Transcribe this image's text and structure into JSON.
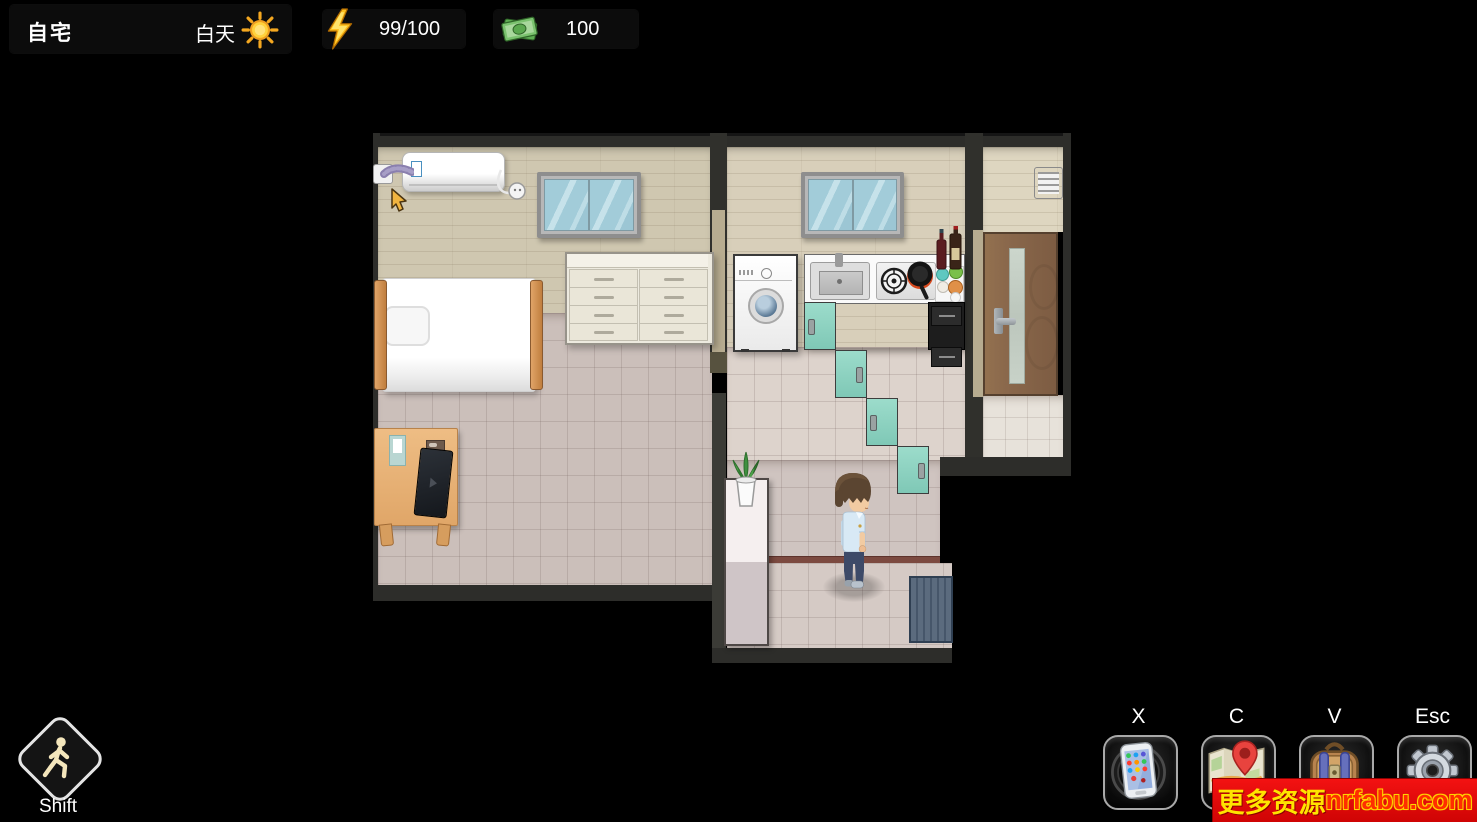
{
  "hud": {
    "location_label": "自宅",
    "time_label": "白天",
    "time_icon": "sun-icon",
    "energy_icon": "lightning-icon",
    "energy_value": "99/100",
    "money_icon": "money-icon",
    "money_value": "100"
  },
  "controls": {
    "walk_label": "Shift",
    "walk_icon": "walking-person-icon",
    "hotkeys": [
      {
        "key": "X",
        "icon": "smartphone-icon"
      },
      {
        "key": "C",
        "icon": "map-icon"
      },
      {
        "key": "V",
        "icon": "backpack-icon"
      },
      {
        "key": "Esc",
        "icon": "gear-icon"
      }
    ]
  },
  "banner": {
    "prefix": "更多资源",
    "site": "nrfabu.com",
    "bg_color": "#e60f0f",
    "prefix_color": "#ffe400",
    "site_color": "#ff2e00"
  },
  "scene": {
    "rooms": [
      "bedroom",
      "kitchen",
      "hallway",
      "entry"
    ],
    "objects": [
      "air-conditioner",
      "power-socket",
      "cable-socket",
      "bedroom-window",
      "bed",
      "pillow",
      "dresser",
      "nightstand",
      "notebook",
      "laptop",
      "kitchen-window",
      "washing-machine",
      "kitchen-sink",
      "gas-stove",
      "frying-pan",
      "wine-bottles",
      "condiment-jars",
      "teal-cabinets",
      "black-drawer-unit",
      "entry-door",
      "wall-vent",
      "potted-plant",
      "hall-shelf",
      "doormat",
      "player-character",
      "mouse-cursor"
    ],
    "palette": {
      "teal_cabinet": "#84ccba",
      "door_brown": "#8a684c",
      "floor_tile": "#cbbfba",
      "wall_wood": "#cfc7b0",
      "doormat_blue": "#5b6b7e"
    }
  }
}
